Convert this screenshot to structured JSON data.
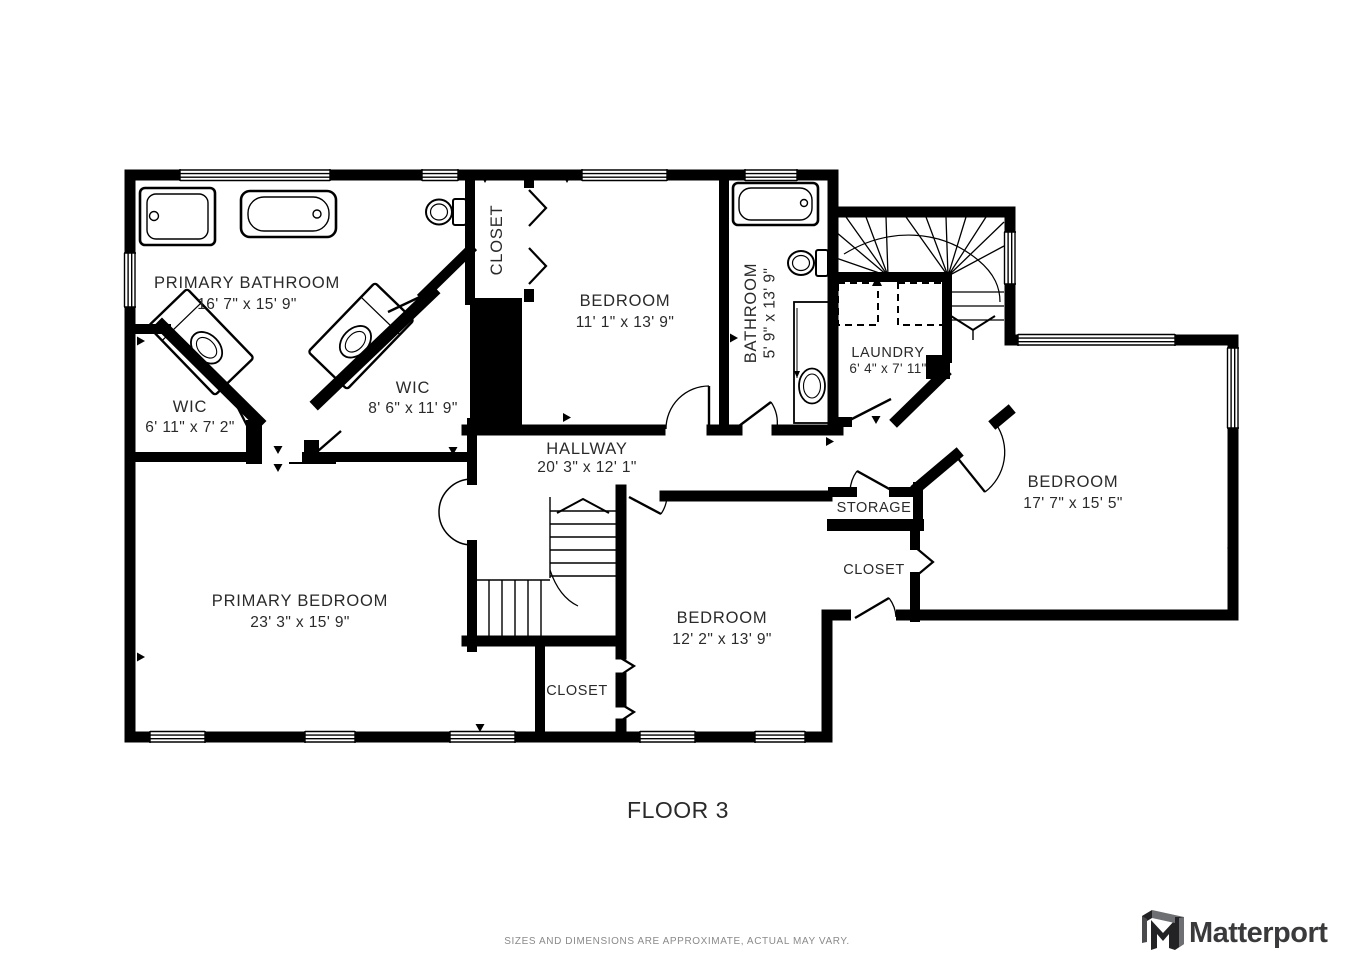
{
  "floor_plan": {
    "rooms": [
      {
        "id": "primary_bathroom",
        "name": "PRIMARY BATHROOM",
        "dims": "16' 7\" x 15' 9\""
      },
      {
        "id": "wic_left",
        "name": "WIC",
        "dims": "6' 11\" x 7' 2\""
      },
      {
        "id": "wic_right",
        "name": "WIC",
        "dims": "8' 6\" x 11' 9\""
      },
      {
        "id": "closet_top",
        "name": "CLOSET",
        "dims": ""
      },
      {
        "id": "bedroom_top",
        "name": "BEDROOM",
        "dims": "11' 1\" x 13' 9\""
      },
      {
        "id": "bathroom",
        "name": "BATHROOM",
        "dims": "5' 9\" x 13' 9\""
      },
      {
        "id": "laundry",
        "name": "LAUNDRY",
        "dims": "6' 4\" x 7' 11\""
      },
      {
        "id": "hallway",
        "name": "HALLWAY",
        "dims": "20' 3\" x 12' 1\""
      },
      {
        "id": "storage",
        "name": "STORAGE",
        "dims": ""
      },
      {
        "id": "closet_right",
        "name": "CLOSET",
        "dims": ""
      },
      {
        "id": "bedroom_right",
        "name": "BEDROOM",
        "dims": "17' 7\" x 15' 5\""
      },
      {
        "id": "primary_bedroom",
        "name": "PRIMARY BEDROOM",
        "dims": "23' 3\" x 15' 9\""
      },
      {
        "id": "closet_bottom",
        "name": "CLOSET",
        "dims": ""
      },
      {
        "id": "bedroom_bottom",
        "name": "BEDROOM",
        "dims": "12' 2\" x 13' 9\""
      }
    ]
  },
  "footer": {
    "floor_label": "FLOOR 3",
    "disclaimer": "SIZES AND DIMENSIONS ARE APPROXIMATE, ACTUAL MAY VARY.",
    "brand": "Matterport"
  },
  "colors": {
    "wall": "#000000",
    "label": "#2a2a2a",
    "disclaimer": "#8a8a8a",
    "brand": "#3a3a3c"
  }
}
